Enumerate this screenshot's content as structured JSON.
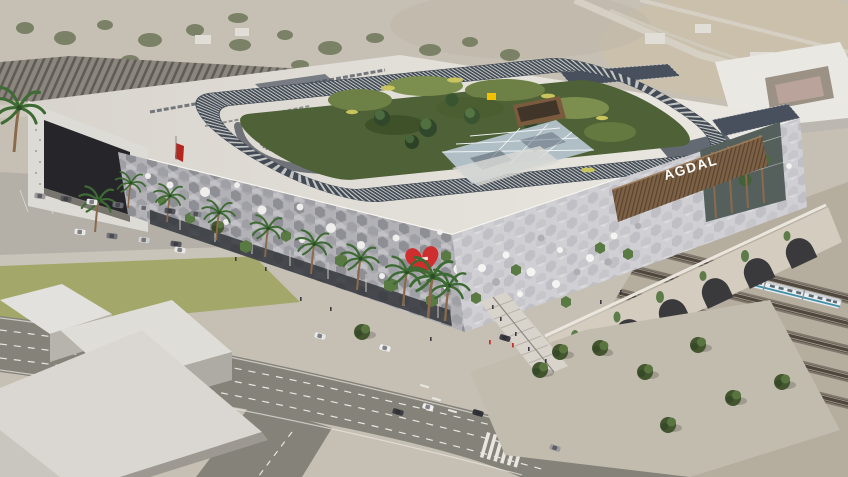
{
  "signs": {
    "roof_sign": "AGDAL",
    "corner_sign_letters": [
      "A",
      "G",
      "D",
      "A",
      "L"
    ]
  },
  "icons": {
    "heart-sign": "red heart emblem on facade corner",
    "yellow-sign": "small yellow storefront sign in roof garden"
  },
  "palette": {
    "background_city": "#c6c0b4",
    "roof": "#e2ded7",
    "facade_hex_front": "#b2b1b6",
    "facade_hex_right": "#cfcfd3",
    "garden_dark": "#4f6136",
    "garden_light": "#7d8f4e",
    "canopy_glass": "#b9c7d2",
    "heart_red": "#cf2e2e",
    "wood_slats": "#7c6146",
    "road_asphalt": "#85827a",
    "viaduct_stone": "#d3ccbf",
    "track_dark": "#4f473d",
    "train_stripe": "#3f8fa6",
    "palm_green": "#3e6b33",
    "lawn_green": "#a3a86a"
  }
}
